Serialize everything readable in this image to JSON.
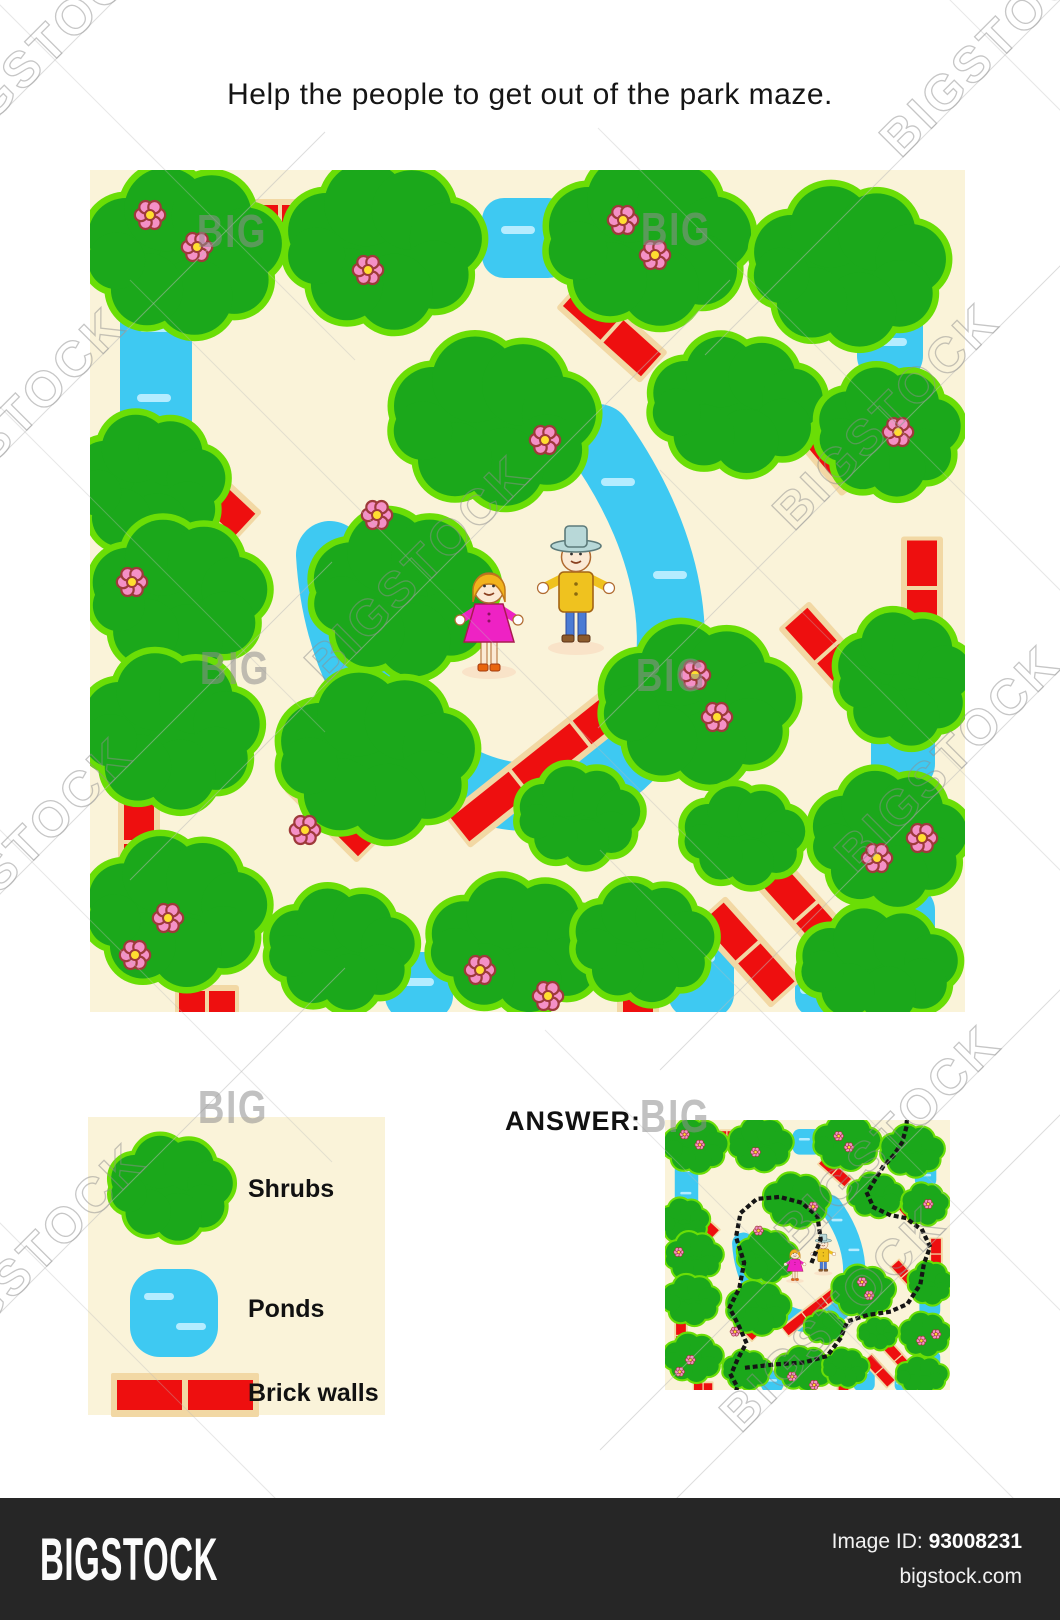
{
  "title": "Help the people to get out of the park maze.",
  "answer_label": "ANSWER:",
  "legend": {
    "items": [
      {
        "icon": "shrub-icon",
        "label": "Shrubs"
      },
      {
        "icon": "pond-icon",
        "label": "Ponds"
      },
      {
        "icon": "brick-wall-icon",
        "label": "Brick walls"
      }
    ]
  },
  "footer": {
    "brand": "BIGSTOCK",
    "image_id_label": "Image ID:",
    "image_id": "93008231",
    "site": "bigstock.com"
  },
  "watermarks": {
    "big_label": "BIG",
    "stock_label": "BIGSTOCK",
    "big_texts": [
      [
        232,
        247
      ],
      [
        676,
        245
      ],
      [
        235,
        684
      ],
      [
        671,
        691
      ],
      [
        233,
        1123
      ],
      [
        675,
        1132
      ]
    ],
    "stock_texts": [
      [
        55,
        60
      ],
      [
        1005,
        55
      ],
      [
        25,
        432
      ],
      [
        898,
        428
      ],
      [
        960,
        770
      ],
      [
        32,
        862
      ],
      [
        430,
        580
      ],
      [
        900,
        1150
      ],
      [
        45,
        1268
      ],
      [
        845,
        1330
      ]
    ]
  },
  "colors": {
    "cream": "#FAF3D9",
    "shrub": "#1BA81B",
    "shrub_outline": "#6ADE06",
    "pond": "#3EC9F2",
    "pond_light": "#B5ECFF",
    "brick": "#EE0F0F",
    "mortar": "#F2D8A4",
    "petal": "#F490C6",
    "petal_outline": "#9E3A3A",
    "flower_center": "#FFDE30",
    "solution": "#151515",
    "skin": "#FBE9D4",
    "skin_outline": "#B06A30",
    "dress": "#EE22C4",
    "dress_outline": "#A81C50",
    "hair": "#F2B31C",
    "hair_outline": "#C07818",
    "shirt": "#EFC21F",
    "shirt_outline": "#A36414",
    "pants": "#4A7BD4",
    "pants_outline": "#2A4A9C",
    "man_shoes": "#8B5A2B",
    "girl_shoes": "#E8650D",
    "hat": "#B8D8D8",
    "hat_outline": "#5C7A7A",
    "shadow": "#F9E3C8",
    "watermark": "#8F8F8F",
    "watermark_line": "#BBBBBB"
  },
  "maze": {
    "width": 875,
    "height": 842,
    "shrubs": [
      [
        95,
        85,
        0.95,
        0.95
      ],
      [
        295,
        80,
        0.95,
        0.95
      ],
      [
        560,
        75,
        1.0,
        0.95
      ],
      [
        760,
        100,
        0.95,
        0.9
      ],
      [
        60,
        318,
        0.72,
        0.82
      ],
      [
        405,
        255,
        1.0,
        0.95
      ],
      [
        648,
        238,
        0.85,
        0.75
      ],
      [
        90,
        430,
        0.85,
        0.88
      ],
      [
        315,
        428,
        0.88,
        0.95
      ],
      [
        800,
        265,
        0.68,
        0.75
      ],
      [
        815,
        512,
        0.62,
        0.8
      ],
      [
        82,
        565,
        0.85,
        0.9
      ],
      [
        288,
        590,
        0.95,
        0.95
      ],
      [
        610,
        538,
        0.95,
        0.9
      ],
      [
        88,
        745,
        0.88,
        0.85
      ],
      [
        252,
        782,
        0.72,
        0.68
      ],
      [
        430,
        778,
        0.9,
        0.72
      ],
      [
        555,
        775,
        0.68,
        0.68
      ],
      [
        800,
        672,
        0.75,
        0.78
      ],
      [
        790,
        798,
        0.8,
        0.6
      ],
      [
        655,
        668,
        0.6,
        0.55
      ],
      [
        490,
        648,
        0.6,
        0.55
      ]
    ],
    "ponds": [
      [
        30,
        112,
        72,
        180,
        28
      ],
      [
        392,
        28,
        88,
        80,
        22
      ],
      [
        767,
        92,
        66,
        120,
        26
      ],
      [
        781,
        508,
        64,
        112,
        26
      ],
      [
        781,
        716,
        64,
        96,
        24
      ],
      [
        295,
        782,
        68,
        68,
        24
      ],
      [
        705,
        800,
        46,
        46,
        18
      ],
      [
        578,
        748,
        66,
        100,
        24
      ]
    ],
    "rivers": [
      "M 240,385 C 245,468 278,558 358,603 C 428,646 515,632 558,562 C 598,494 588,380 508,268"
    ],
    "pond_dashes": [
      [
        66,
        158
      ],
      [
        64,
        228
      ],
      [
        428,
        60
      ],
      [
        800,
        128
      ],
      [
        800,
        172
      ],
      [
        272,
        440
      ],
      [
        345,
        598
      ],
      [
        580,
        405
      ],
      [
        528,
        312
      ],
      [
        608,
        788
      ],
      [
        327,
        812
      ],
      [
        812,
        548
      ],
      [
        812,
        744
      ],
      [
        727,
        820
      ]
    ],
    "bricks": [
      [
        190,
        50,
        100,
        0,
        2
      ],
      [
        522,
        160,
        105,
        42,
        2
      ],
      [
        727,
        265,
        118,
        50,
        2
      ],
      [
        120,
        322,
        96,
        43,
        2
      ],
      [
        460,
        588,
        230,
        -38.5,
        3
      ],
      [
        49,
        672,
        82,
        90,
        2
      ],
      [
        117,
        836,
        56,
        0,
        2
      ],
      [
        548,
        808,
        70,
        90,
        2
      ],
      [
        658,
        782,
        106,
        48,
        2
      ],
      [
        716,
        742,
        116,
        48,
        2
      ],
      [
        832,
        418,
        95,
        90,
        2
      ],
      [
        737,
        482,
        92,
        48,
        2
      ],
      [
        245,
        642,
        95,
        45,
        2
      ]
    ],
    "flowers": [
      [
        60,
        45
      ],
      [
        107,
        77
      ],
      [
        278,
        100
      ],
      [
        533,
        50
      ],
      [
        565,
        85
      ],
      [
        455,
        270
      ],
      [
        808,
        262
      ],
      [
        42,
        412
      ],
      [
        287,
        345
      ],
      [
        215,
        660
      ],
      [
        605,
        505
      ],
      [
        627,
        547
      ],
      [
        45,
        785
      ],
      [
        78,
        748
      ],
      [
        390,
        800
      ],
      [
        458,
        826
      ],
      [
        787,
        688
      ],
      [
        832,
        668
      ]
    ],
    "people": {
      "girl": [
        399,
        446
      ],
      "man": [
        486,
        418
      ]
    },
    "solution": [
      [
        [
          452,
          440
        ],
        [
          478,
          372
        ],
        [
          468,
          300
        ],
        [
          420,
          258
        ],
        [
          352,
          240
        ],
        [
          282,
          246
        ],
        [
          232,
          290
        ],
        [
          218,
          365
        ],
        [
          243,
          445
        ],
        [
          228,
          525
        ],
        [
          198,
          585
        ],
        [
          228,
          645
        ],
        [
          250,
          695
        ],
        [
          222,
          748
        ],
        [
          202,
          795
        ],
        [
          222,
          832
        ],
        [
          212,
          868
        ]
      ],
      [
        [
          252,
          772
        ],
        [
          340,
          762
        ],
        [
          428,
          756
        ],
        [
          498,
          736
        ],
        [
          538,
          682
        ],
        [
          560,
          628
        ],
        [
          622,
          608
        ],
        [
          690,
          598
        ],
        [
          744,
          574
        ],
        [
          784,
          512
        ],
        [
          795,
          448
        ],
        [
          814,
          396
        ],
        [
          790,
          344
        ],
        [
          740,
          306
        ],
        [
          690,
          296
        ],
        [
          640,
          272
        ],
        [
          620,
          228
        ],
        [
          645,
          186
        ],
        [
          668,
          148
        ],
        [
          702,
          110
        ],
        [
          728,
          70
        ],
        [
          740,
          26
        ],
        [
          744,
          -10
        ]
      ]
    ]
  }
}
